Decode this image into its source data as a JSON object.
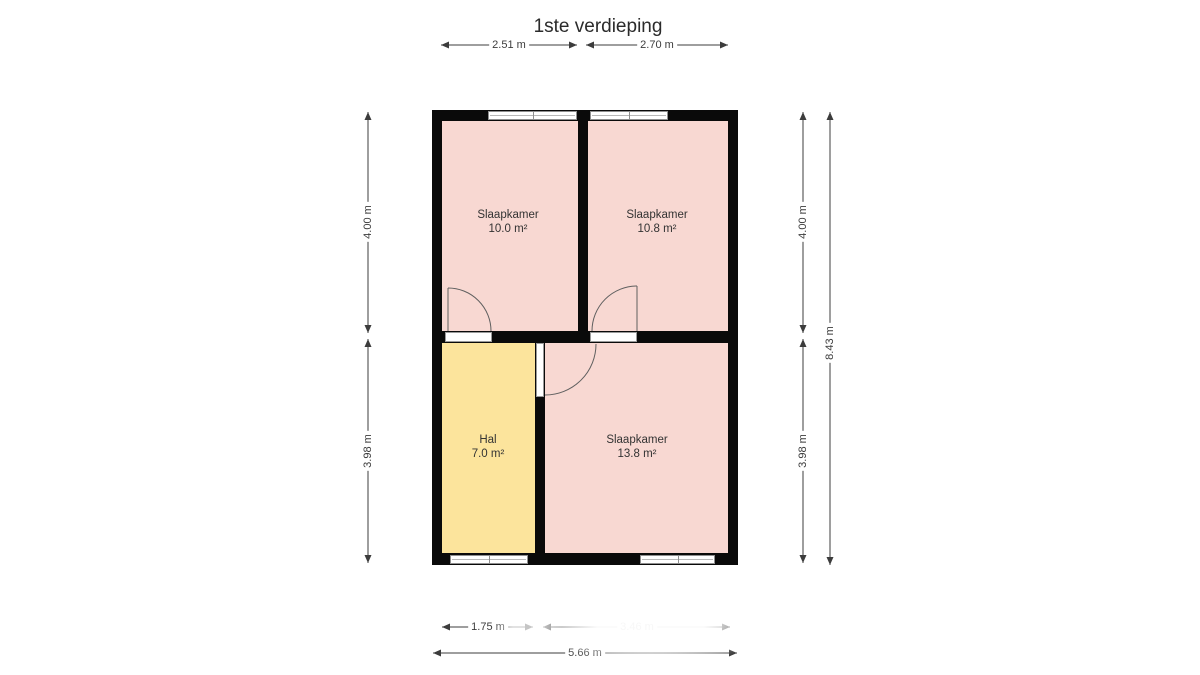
{
  "title": "1ste verdieping",
  "rooms": [
    {
      "name": "Slaapkamer",
      "area": "10.0 m²"
    },
    {
      "name": "Slaapkamer",
      "area": "10.8 m²"
    },
    {
      "name": "Hal",
      "area": "7.0 m²"
    },
    {
      "name": "Slaapkamer",
      "area": "13.8 m²"
    }
  ],
  "dimensions": {
    "top": [
      "2.51 m",
      "2.70 m"
    ],
    "left": [
      "4.00 m",
      "3.98 m"
    ],
    "right": [
      "4.00 m",
      "3.98 m"
    ],
    "total_height": "8.43 m",
    "bottom": [
      "1.75 m",
      "3.46 m"
    ],
    "total_width": "5.66 m"
  },
  "colors": {
    "room_pink": "#f8d8d2",
    "hall_yellow": "#fce49c",
    "wall": "#0a0a0a",
    "dimension": "#3c3c3c"
  }
}
